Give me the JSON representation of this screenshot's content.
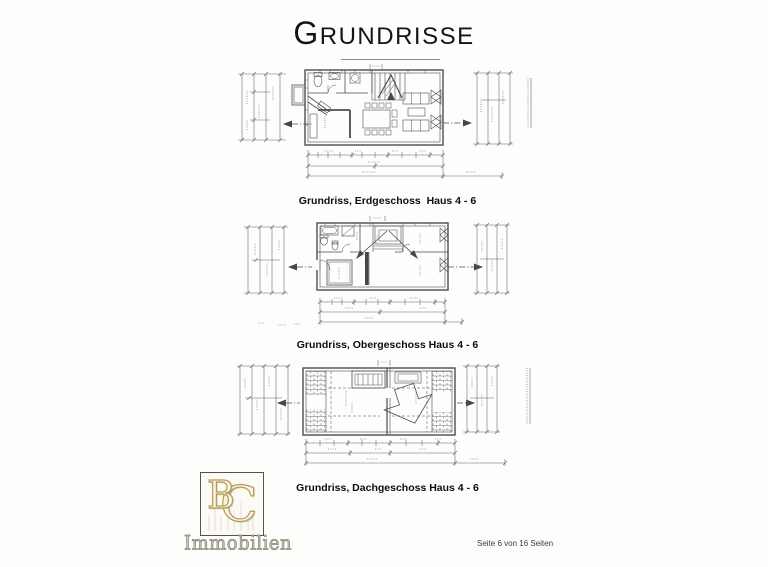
{
  "page": {
    "title_first": "G",
    "title_rest": "RUNDRISSE",
    "footer": "Seite 6 von 16 Seiten"
  },
  "plans": [
    {
      "caption": "Grundriss, Erdgeschoss  Haus 4 - 6"
    },
    {
      "caption": "Grundriss, Obergeschoss Haus 4 - 6"
    },
    {
      "caption": "Grundriss, Dachgeschoss Haus 4 - 6"
    }
  ],
  "logo": {
    "letter_b": "B",
    "letter_c": "C",
    "subtitle": "Immobilien"
  },
  "colors": {
    "drawing_line": "#4d4d4d",
    "logo_gold": "#b59c55",
    "caption_text": "#0d0d0d"
  }
}
